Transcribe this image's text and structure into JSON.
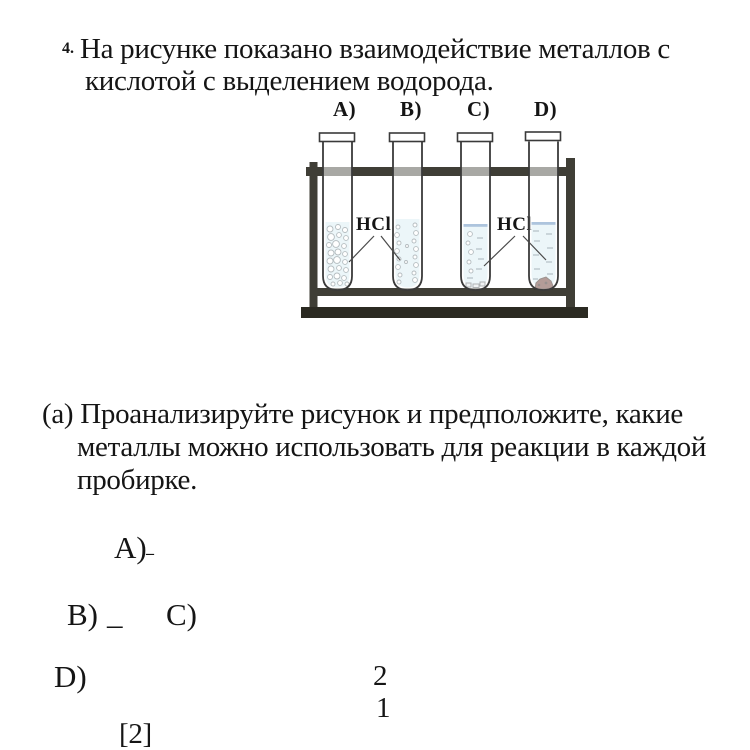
{
  "question": {
    "number": "4.",
    "lines": [
      "На рисунке показано взаимодействие металлов с",
      "кислотой с выделением водорода."
    ]
  },
  "figure": {
    "tube_labels": [
      "A)",
      "B)",
      "C)",
      "D)"
    ],
    "acid_labels": [
      "HCl",
      "HCl"
    ],
    "colors": {
      "liquid": "#d5ecf1",
      "surface": "#4a7db3",
      "metal": "#5a241c",
      "stand": "#3f3e36",
      "base": "#2b2a22",
      "outline": "#3a3a3a"
    }
  },
  "part_a": {
    "lines": [
      "(а) Проанализируйте рисунок и предположите, какие",
      "металлы можно использовать для реакции в каждой",
      "пробирке."
    ]
  },
  "answers": {
    "a_label": "А)",
    "a_blank": "_",
    "b_label": "B)",
    "b_blank": "_",
    "c_label": "C)",
    "d_label": "D)"
  },
  "numbers": {
    "upper": "2",
    "lower": "1"
  },
  "marks": "[2]"
}
